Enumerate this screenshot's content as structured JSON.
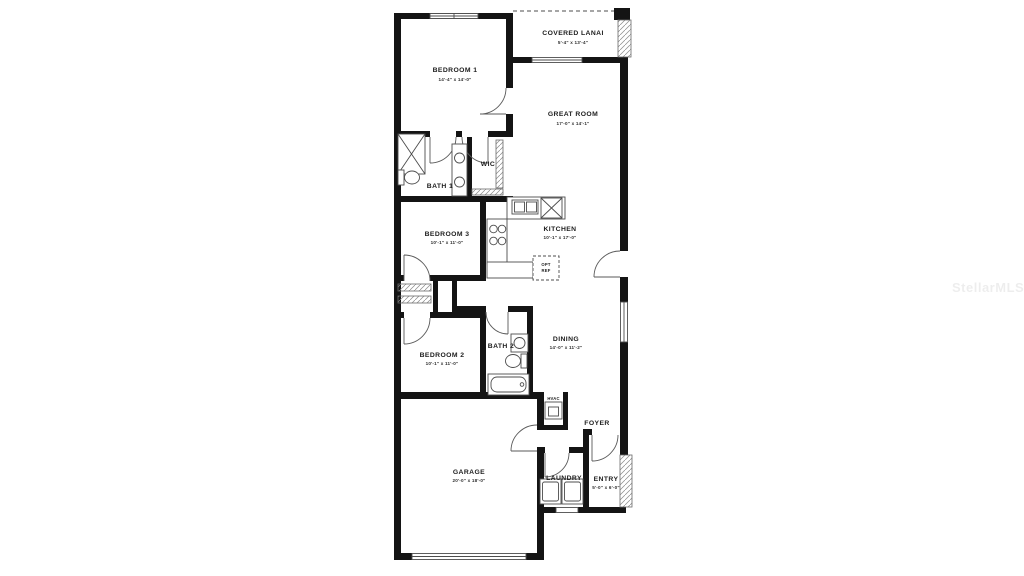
{
  "watermark": "StellarMLS",
  "colors": {
    "wall": "#141414",
    "line": "#4d4d4d",
    "text": "#1c1c1c",
    "watermark_text": "rgba(0,0,0,0.07)"
  },
  "rooms": [
    {
      "id": "bedroom1",
      "label": "BEDROOM 1",
      "dims": "14'-4\" x 14'-0\""
    },
    {
      "id": "covered-lanai",
      "label": "COVERED LANAI",
      "dims": "5'-4\" x 13'-4\""
    },
    {
      "id": "great-room",
      "label": "GREAT ROOM",
      "dims": "17'-0\" x 14'-1\""
    },
    {
      "id": "bath1",
      "label": "BATH 1",
      "dims": ""
    },
    {
      "id": "wic",
      "label": "WIC",
      "dims": ""
    },
    {
      "id": "bedroom3",
      "label": "BEDROOM 3",
      "dims": "10'-1\" x 11'-0\""
    },
    {
      "id": "kitchen",
      "label": "KITCHEN",
      "dims": "10'-1\" x 17'-0\""
    },
    {
      "id": "bedroom2",
      "label": "BEDROOM 2",
      "dims": "10'-1\" x 11'-0\""
    },
    {
      "id": "bath2",
      "label": "BATH 2",
      "dims": ""
    },
    {
      "id": "dining",
      "label": "DINING",
      "dims": "14'-0\" x 11'-2\""
    },
    {
      "id": "foyer",
      "label": "FOYER",
      "dims": ""
    },
    {
      "id": "laundry",
      "label": "LAUNDRY",
      "dims": ""
    },
    {
      "id": "entry",
      "label": "ENTRY",
      "dims": "5'-0\" x 6'-0\""
    },
    {
      "id": "garage",
      "label": "GARAGE",
      "dims": "20'-0\" x 18'-0\""
    }
  ],
  "annotations": {
    "opt": "OPT",
    "ref": "REF",
    "hvac": "HVAC"
  }
}
